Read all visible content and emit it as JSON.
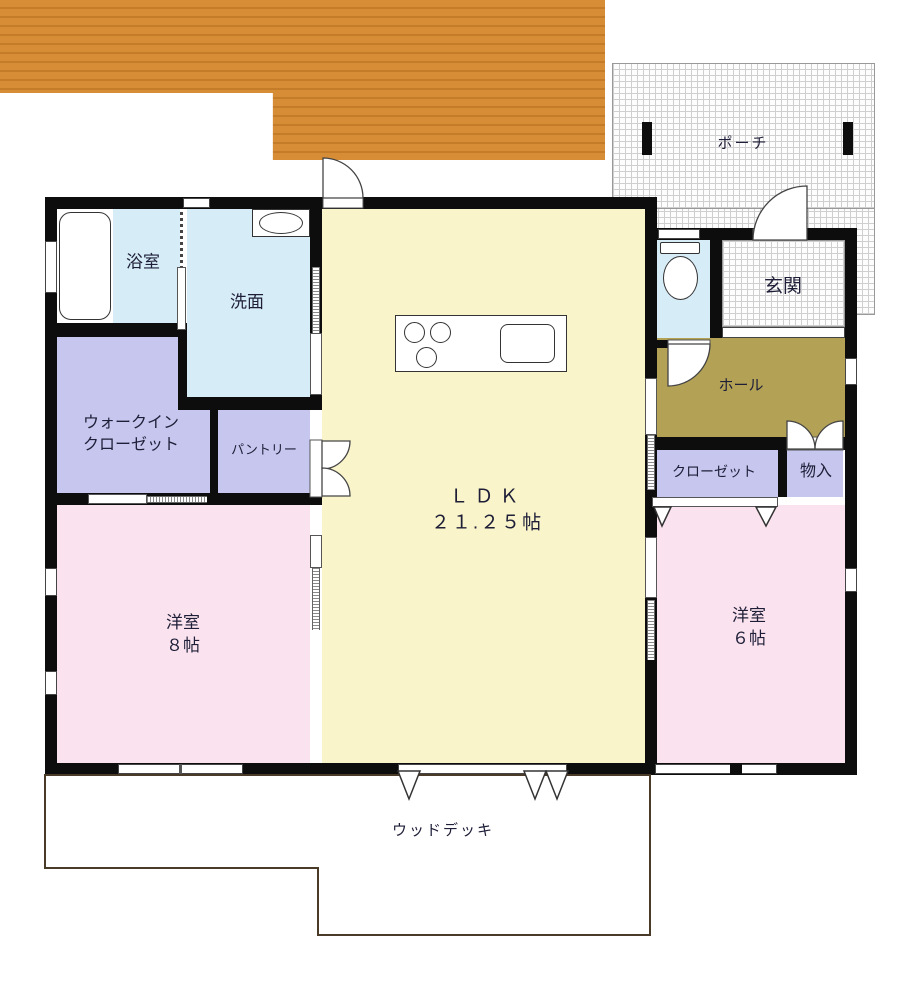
{
  "title": "間取り図",
  "rooms": {
    "porch": {
      "label": "ポーチ"
    },
    "bathroom": {
      "label": "浴室"
    },
    "washroom": {
      "label": "洗面"
    },
    "entrance": {
      "label": "玄関"
    },
    "hall": {
      "label": "ホール"
    },
    "walk_in_closet": {
      "label_line1": "ウォークイン",
      "label_line2": "クローゼット"
    },
    "pantry": {
      "label": "パントリー"
    },
    "closet": {
      "label": "クローゼット"
    },
    "storage": {
      "label": "物入"
    },
    "ldk": {
      "label": "ＬＤＫ",
      "area": "２１.２５帖"
    },
    "bedroom_8": {
      "label": "洋室",
      "area": "８帖"
    },
    "bedroom_6": {
      "label": "洋室",
      "area": "６帖"
    },
    "wood_deck": {
      "label": "ウッドデッキ"
    }
  },
  "fixtures": [
    "bathtub",
    "vanity-sink",
    "toilet",
    "kitchen-island-stove-sink"
  ],
  "colors": {
    "wall": "#0d0d0d",
    "ldk_fill": "#f9f4c9",
    "bedroom_fill": "#fae3ee",
    "wet_area_fill": "#d6ecf7",
    "closet_fill": "#c6c6ee",
    "hall_fill": "#b3a256",
    "deck_fill": "#d78d35",
    "deck_plank_line": "#c47c28",
    "label_text": "#1e1e38"
  }
}
